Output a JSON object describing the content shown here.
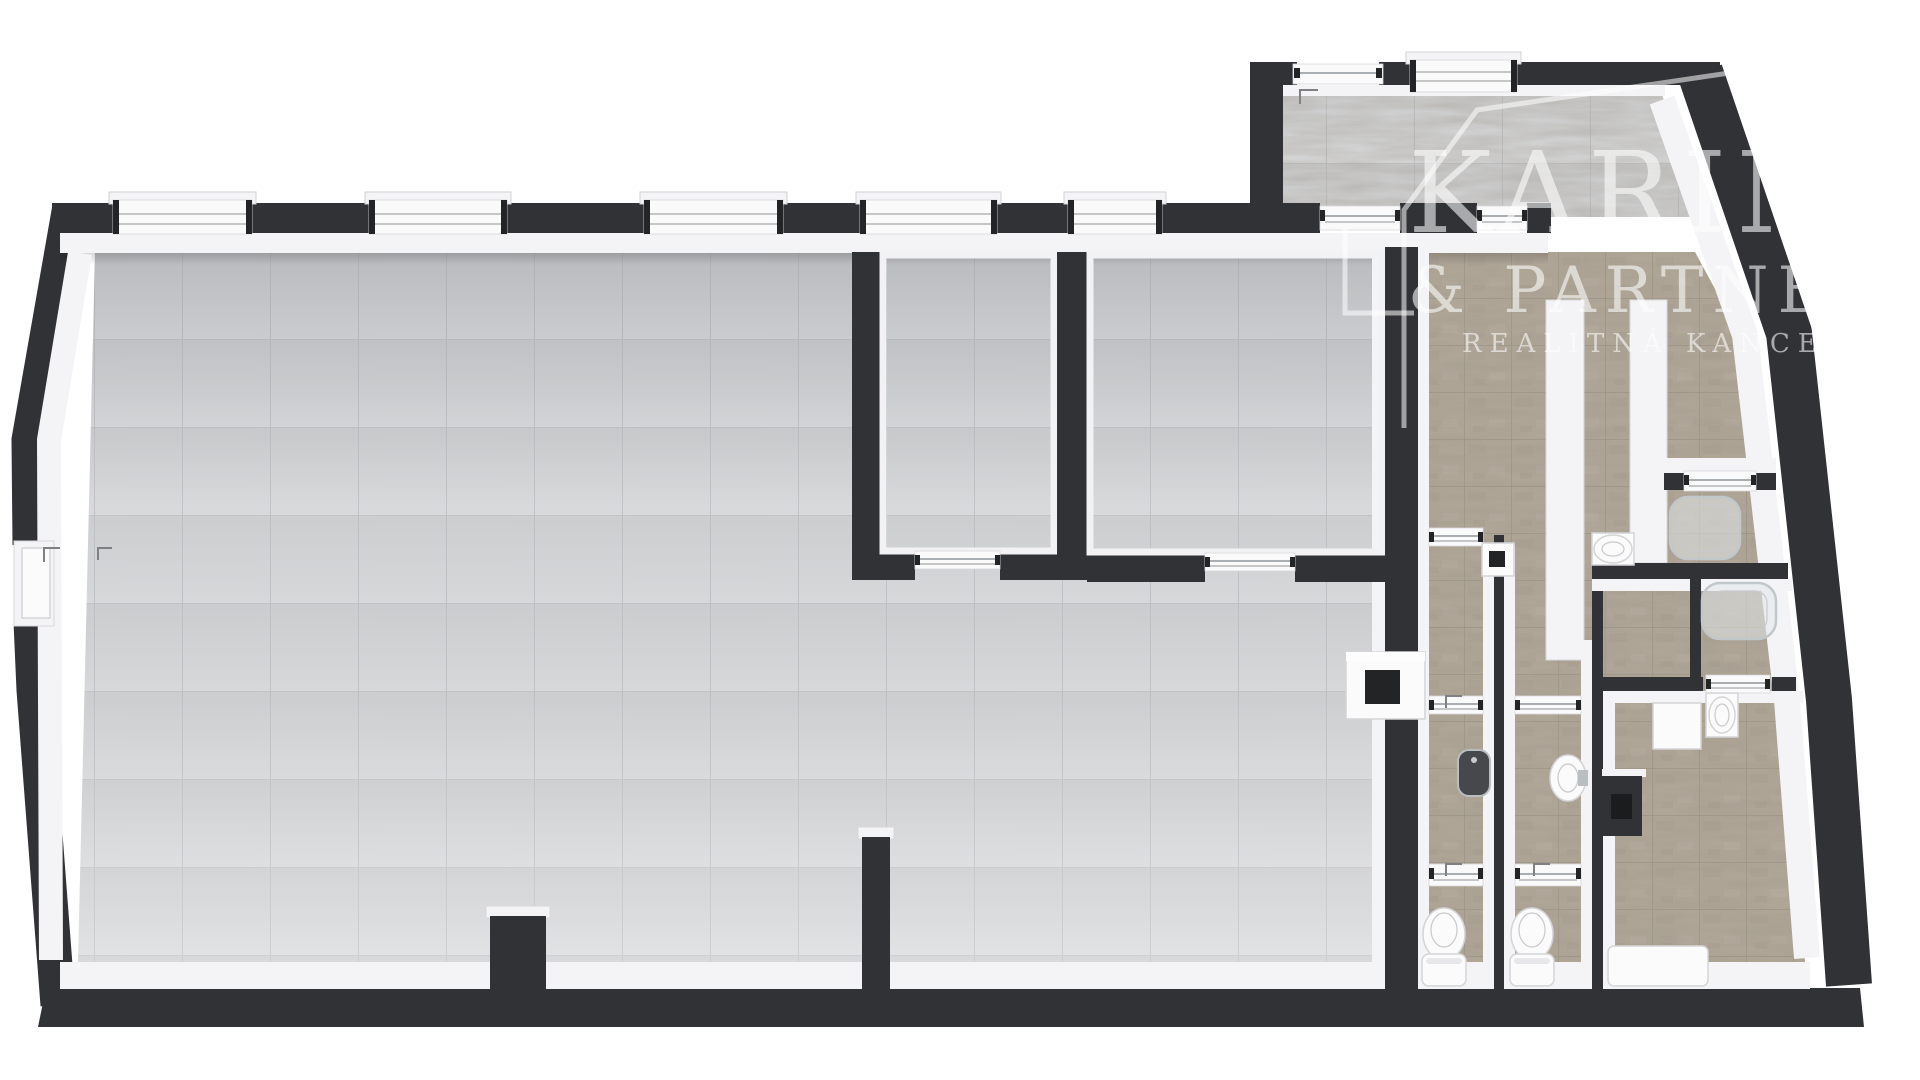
{
  "title": "3D floor plan render (top-down)",
  "watermark": {
    "line1": "KARIN",
    "line2": "& PARTNERS",
    "line3": "REALITNÁ KANCELÁRIA",
    "logo": "house-outline-logo",
    "color": "#ffffff",
    "opacity": 0.58
  },
  "palette": {
    "background": "#ffffff",
    "wall": "#313235",
    "wall-dark": "#232426",
    "white-wall": "#f4f4f6",
    "white-fixture": "#fbfbfc",
    "fixture-stroke": "#d5d5d8",
    "floor-tile": "#d2d3d5",
    "floor-grout": "#bcbdc0",
    "travertine": "#b2a899",
    "travertine-grout": "#97907f",
    "chrome": "#a9aeb3",
    "swing-mark": "#7e8084",
    "watermark-color": "#ffffff"
  },
  "fixtures": {
    "toilets": 2,
    "washbasins": 4,
    "urinals": 1,
    "glass_shower_cabins": 2,
    "shower_trays": 1,
    "sink_cabinets": 2,
    "door_thresholds": 11,
    "windows": 6,
    "entrance_doors": 2,
    "door_swing_marks": 5,
    "wall_stubs": 2
  }
}
